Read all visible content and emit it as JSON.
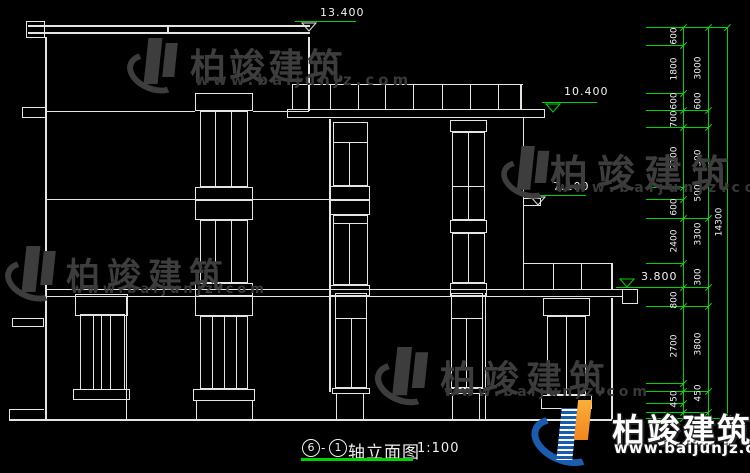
{
  "colors": {
    "background": "#000000",
    "drawing_line": "#e4e4e4",
    "dimension_green": "#00d400",
    "text_white": "#f2f2f2",
    "watermark_gray": "#3d3d3d",
    "logo_blue": "#1a5cad",
    "logo_orange": "#f7941e"
  },
  "brand": {
    "name": "柏竣建筑",
    "url": "www.baijunjz.com"
  },
  "title_bar": {
    "axis_start": "6",
    "separator": "-",
    "axis_end": "1",
    "title": "轴立面图",
    "scale": "1:100"
  },
  "elevation_markers": [
    {
      "value": "13.400",
      "text_x": 320,
      "text_y": 6,
      "line_x1": 295,
      "line_x2": 356,
      "line_y": 21,
      "tri_x": 301,
      "tri_below": true,
      "tri_color": "#e4e4e4"
    },
    {
      "value": "10.400",
      "text_x": 564,
      "text_y": 85,
      "line_x1": 542,
      "line_x2": 597,
      "line_y": 102,
      "tri_x": 545,
      "tri_below": true,
      "tri_color": "#00d400"
    },
    {
      "value": "7.100",
      "text_x": 553,
      "text_y": 180,
      "line_x1": 524,
      "line_x2": 586,
      "line_y": 195,
      "tri_x": 530,
      "tri_below": true,
      "tri_color": "#e4e4e4"
    },
    {
      "value": "3.800",
      "text_x": 641,
      "text_y": 270,
      "line_x1": 616,
      "line_x2": 684,
      "line_y": 287,
      "tri_x": 619,
      "tri_below": false,
      "tri_color": "#00d400"
    }
  ],
  "dimension_chains": {
    "inner": {
      "line_x": 683,
      "label_x": 675,
      "labels": [
        {
          "text": "600",
          "y": 36
        },
        {
          "text": "1800",
          "y": 69
        },
        {
          "text": "600",
          "y": 101
        },
        {
          "text": "700",
          "y": 119
        },
        {
          "text": "2100",
          "y": 158
        },
        {
          "text": "600",
          "y": 207
        },
        {
          "text": "2400",
          "y": 241
        },
        {
          "text": "800",
          "y": 300
        },
        {
          "text": "2700",
          "y": 346
        },
        {
          "text": "450",
          "y": 399
        }
      ]
    },
    "middle": {
      "line_x": 708,
      "label_x": 699,
      "labels": [
        {
          "text": "3000",
          "y": 68
        },
        {
          "text": "600",
          "y": 101
        },
        {
          "text": "3300",
          "y": 161
        },
        {
          "text": "500",
          "y": 193
        },
        {
          "text": "3300",
          "y": 234
        },
        {
          "text": "300",
          "y": 277
        },
        {
          "text": "3800",
          "y": 344
        },
        {
          "text": "450",
          "y": 393
        }
      ]
    },
    "outer": {
      "line_x": 727,
      "label_x": 720,
      "labels": [
        {
          "text": "14300",
          "y": 222
        }
      ]
    }
  },
  "extension_ticks": {
    "to_inner": [
      45,
      93,
      187,
      199,
      263,
      383,
      403
    ],
    "to_middle": [
      110,
      127,
      218,
      287,
      306,
      391,
      412
    ],
    "to_outer": [
      27,
      418
    ]
  }
}
